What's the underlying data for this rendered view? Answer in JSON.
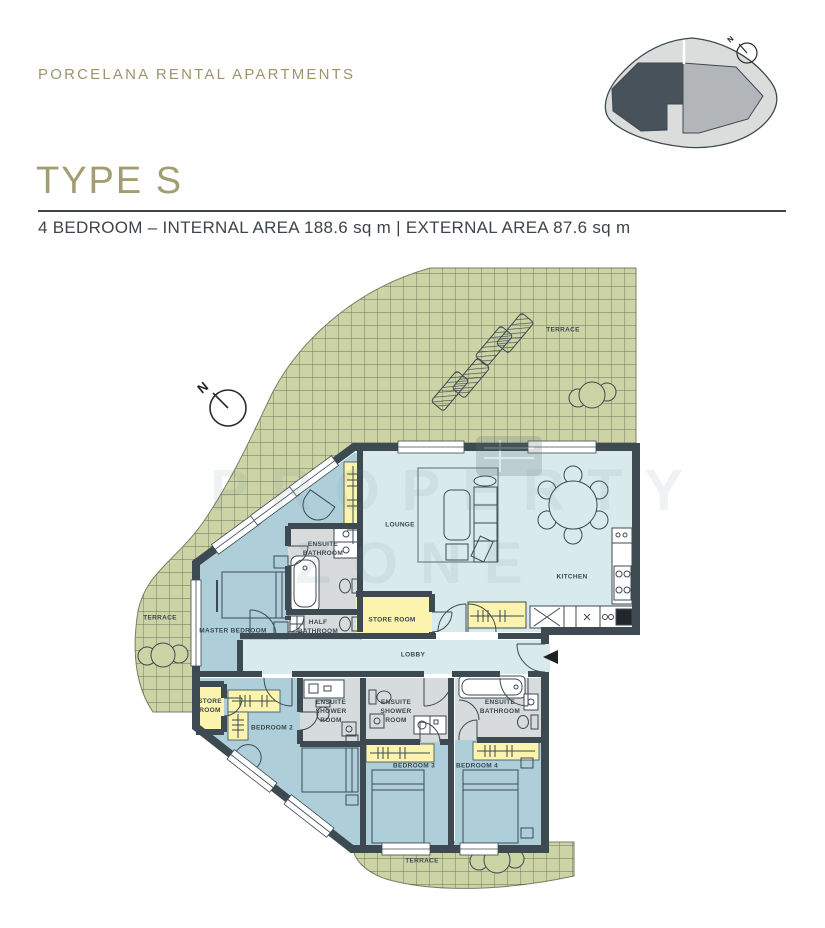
{
  "header": {
    "brand": "PORCELANA RENTAL APARTMENTS",
    "title": "TYPE S",
    "subtitle": "4 BEDROOM – INTERNAL AREA 188.6 sq m | EXTERNAL AREA 87.6 sq m"
  },
  "plan": {
    "north_label": "N",
    "rooms": {
      "terrace_top": "TERRACE",
      "terrace_left": "TERRACE",
      "terrace_bottom": "TERRACE",
      "lounge": "LOUNGE",
      "kitchen": "KITCHEN",
      "lobby": "LOBBY",
      "master_bedroom": "MASTER BEDROOM",
      "ensuite_bathroom_master": "ENSUITE BATHROOM",
      "half_bathroom": "HALF BATHROOM",
      "store_room_main": "STORE ROOM",
      "store_room_bedroom2": "STORE ROOM",
      "bedroom_2": "BEDROOM 2",
      "bedroom_3": "BEDROOM 3",
      "bedroom_4": "BEDROOM 4",
      "ensuite_shower_room_2": "ENSUITE SHOWER ROOM",
      "ensuite_shower_room_3": "ENSUITE SHOWER ROOM",
      "ensuite_bathroom_4": "ENSUITE BATHROOM"
    }
  },
  "locator": {
    "north_label": "N"
  },
  "watermark": {
    "line1": "PROPERTY",
    "line2": "ZONE"
  },
  "colors": {
    "brand_olive": "#9c956c",
    "wall": "#3d4a52",
    "terrace_green": "#ccd3a5",
    "living_blue": "#d9eaec",
    "bedroom_blue": "#aecfd9",
    "closet_yellow": "#fbf3ae",
    "bathroom_grey": "#d8dbdc",
    "locator_dark": "#47525a",
    "locator_mid": "#b3b6b8",
    "locator_light": "#dbdddd"
  }
}
